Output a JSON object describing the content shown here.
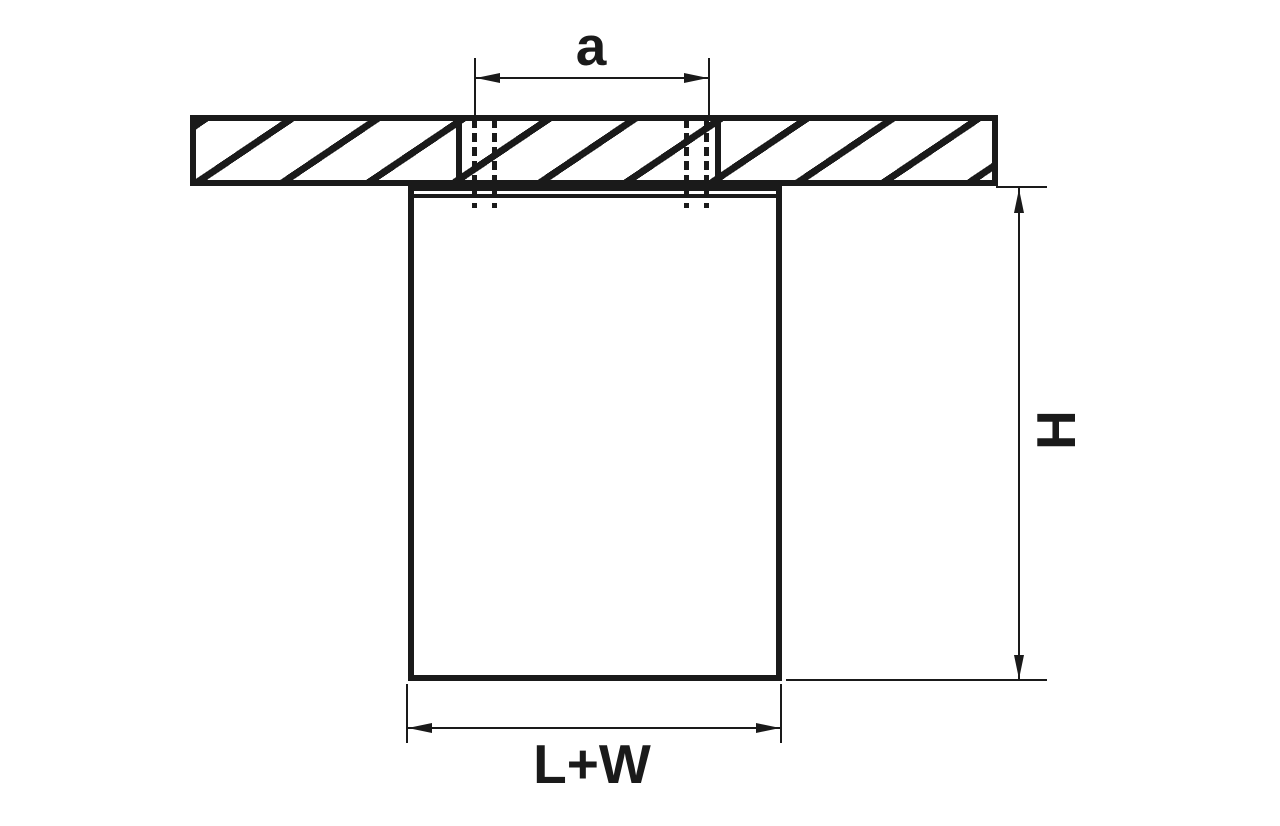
{
  "diagram": {
    "type": "fixture-dimension-drawing",
    "labels": {
      "hole_spacing": "a",
      "height": "H",
      "width": "L+W"
    },
    "colors": {
      "line": "#1a1a1a",
      "background": "#ffffff"
    }
  }
}
